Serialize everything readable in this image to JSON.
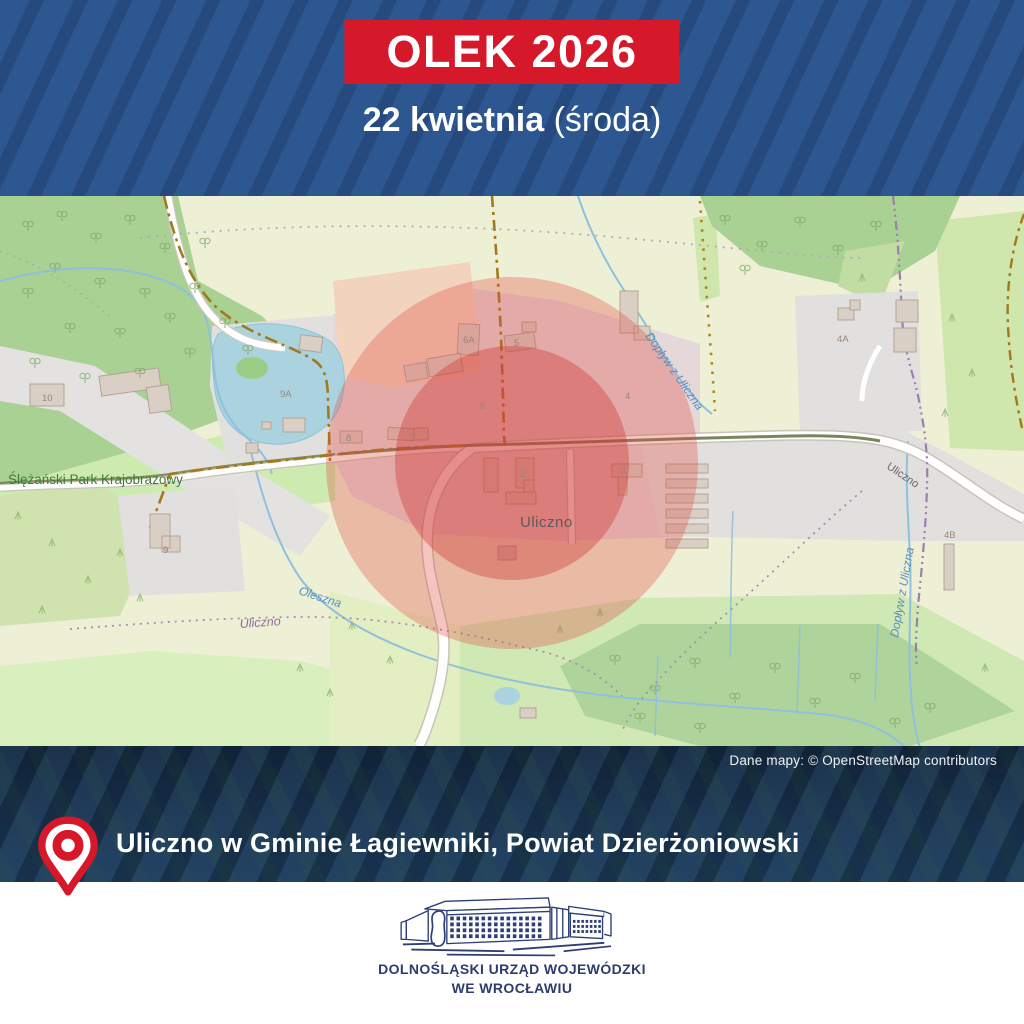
{
  "header": {
    "event_title": "OLEK 2026",
    "date_bold": "22 kwietnia",
    "date_weekday": " (środa)"
  },
  "map": {
    "attribution": "Dane mapy: © OpenStreetMap contributors",
    "labels": {
      "park": "Ślężański Park Krajobrazowy",
      "village": "Uliczno",
      "boundary_locality": "Uliczno",
      "road": "Uliczno",
      "stream_oleszna": "Oleszna",
      "stream_doplyw_1": "Dopływ z Uliczna",
      "stream_doplyw_2": "Dopływ z Uliczna"
    },
    "houses": {
      "h10": "10",
      "h9a": "9A",
      "h9": "9",
      "h8": "8",
      "h7": "7",
      "h6": "6",
      "h6a": "6A",
      "h5": "5",
      "h4": "4",
      "h4a": "4A",
      "h4b": "4B",
      "h3": "3",
      "h2": "2"
    }
  },
  "location": {
    "text": "Uliczno w Gminie Łagiewniki, Powiat Dzierżoniowski"
  },
  "footer": {
    "org_line1": "DOLNOŚLĄSKI URZĄD WOJEWÓDZKI",
    "org_line2": "WE WROCŁAWIU"
  },
  "colors": {
    "banner_red": "#d6182b",
    "header_blue": "#2d5791",
    "header_stripe": "#264a7d",
    "zone_red_outer": "rgba(224,74,64,0.32)",
    "zone_red_inner": "rgba(203,48,48,0.37)",
    "navy_logo": "#2e3f76",
    "dark_band": "#152a42"
  }
}
